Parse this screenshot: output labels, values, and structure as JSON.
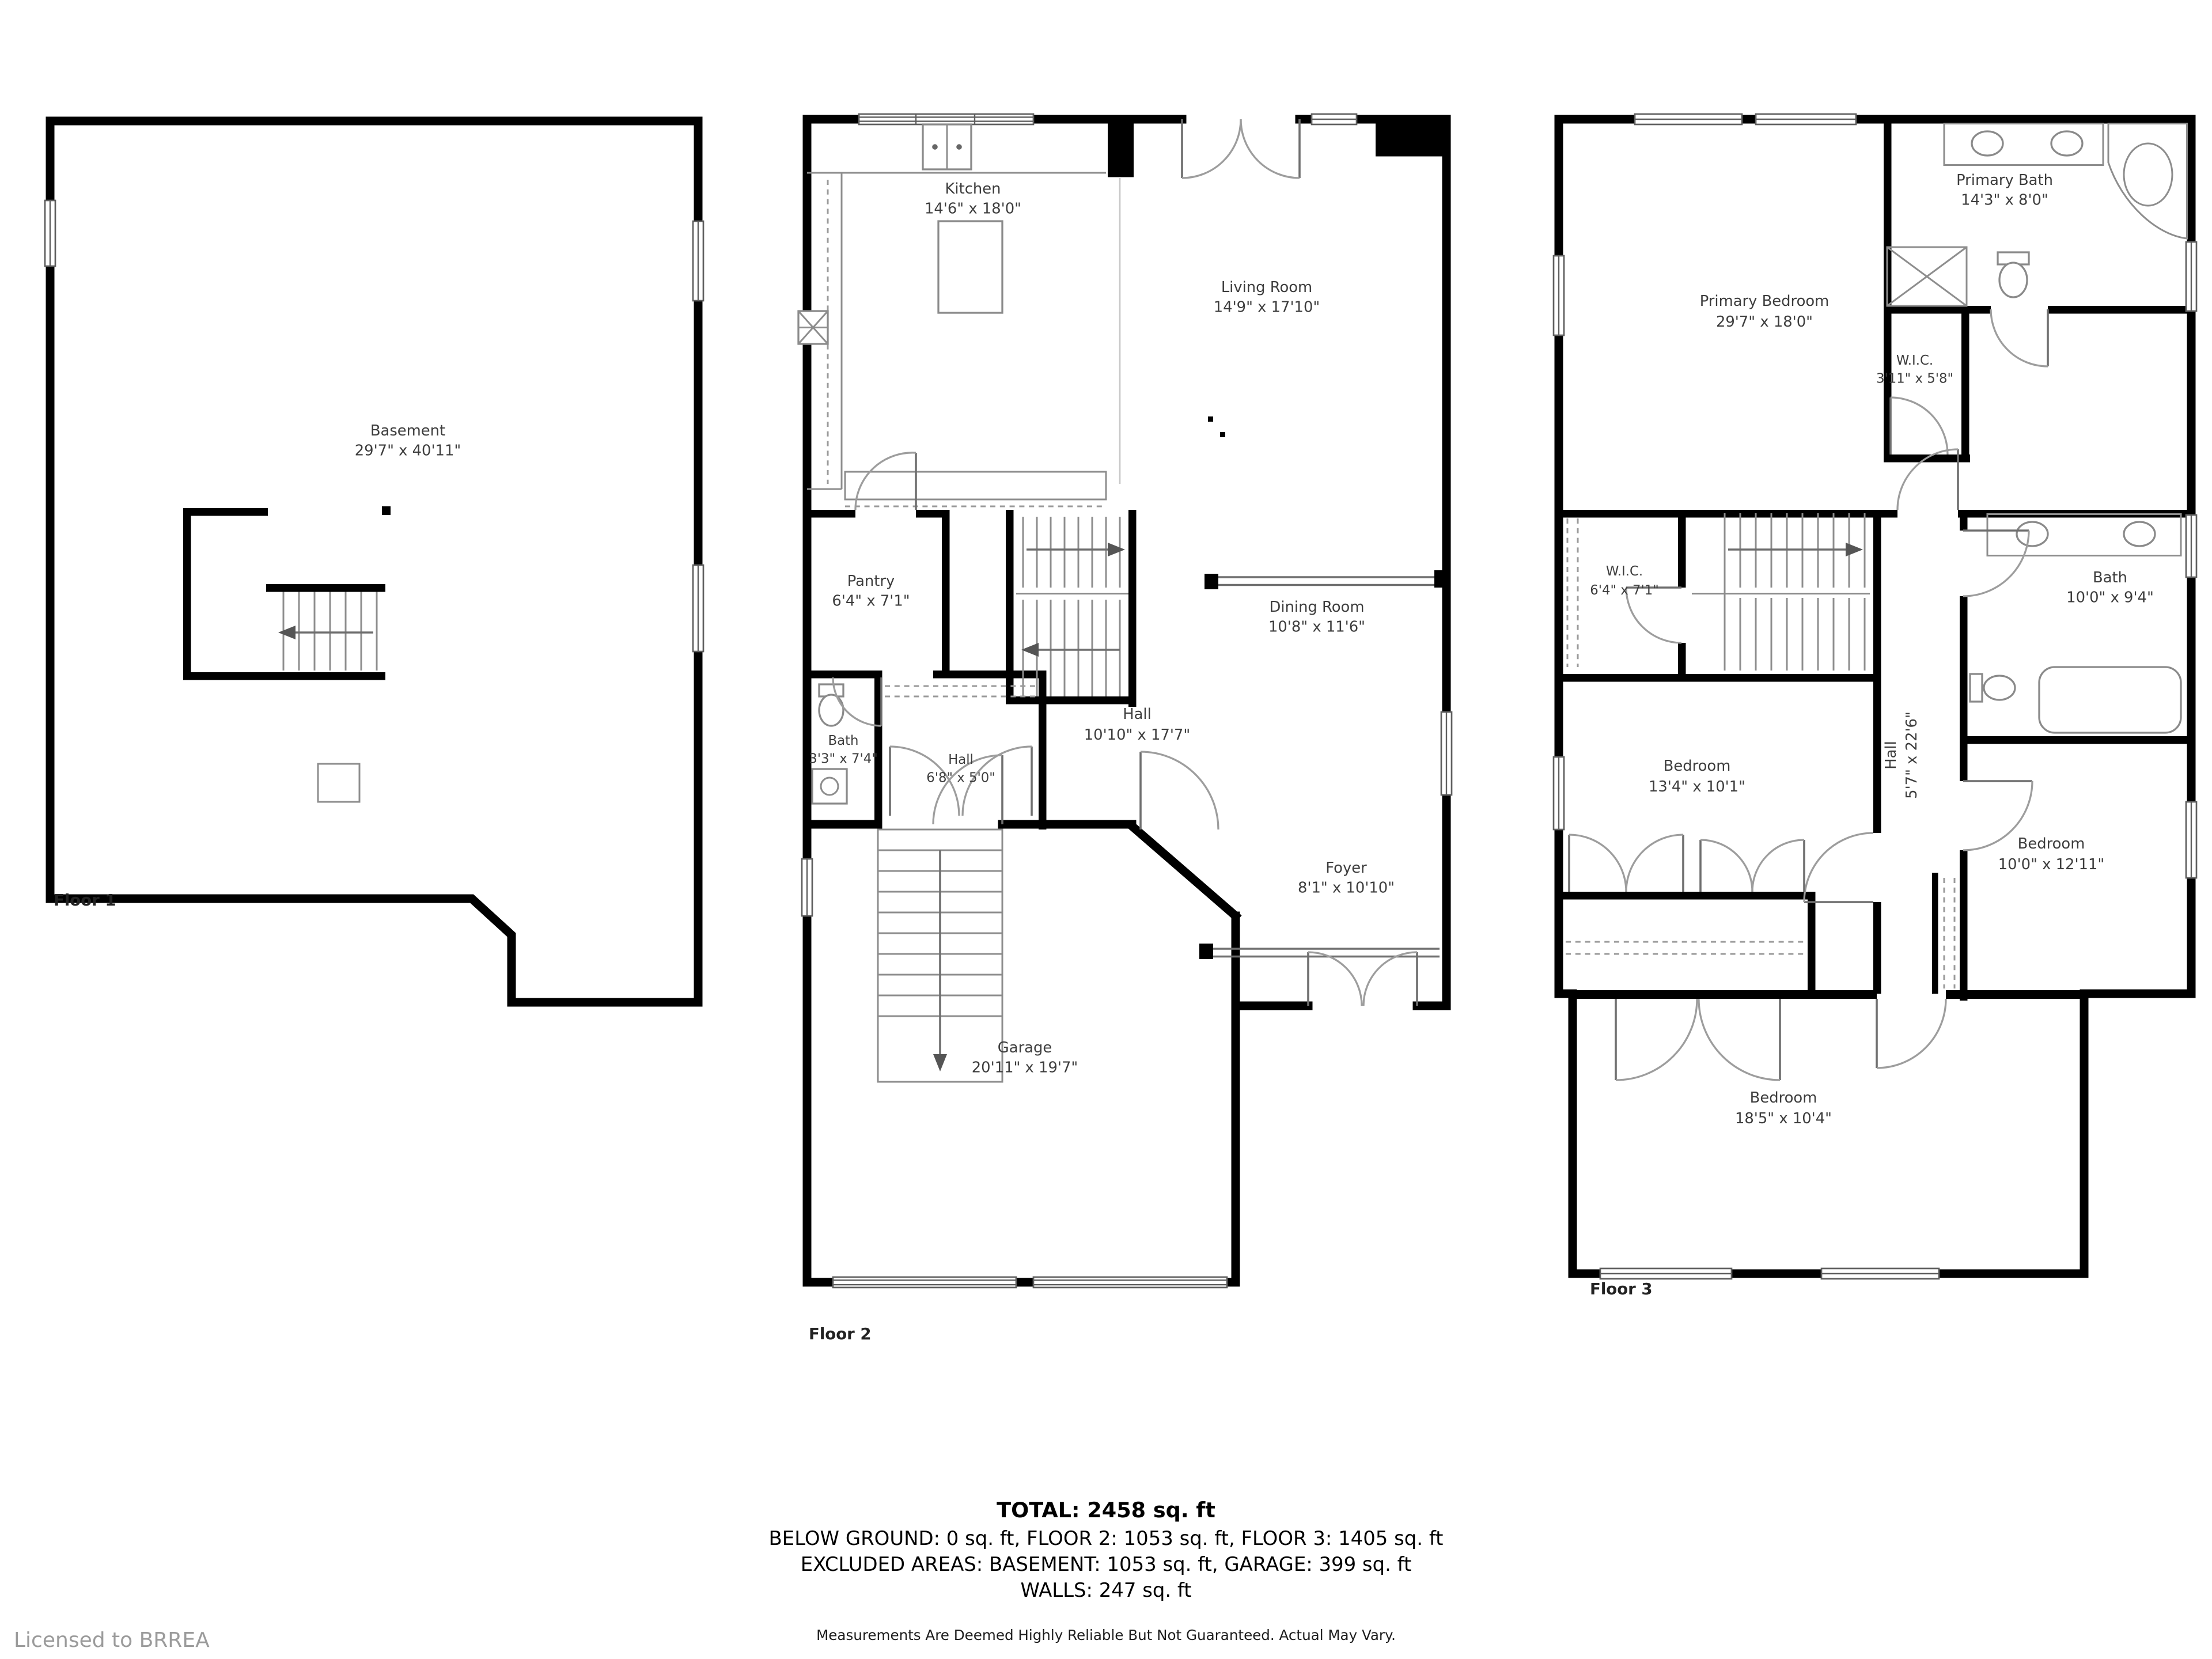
{
  "branding": {
    "licensed_to": "Licensed to BRREA"
  },
  "floors": [
    {
      "label": "Floor 1",
      "rooms": [
        {
          "name": "Basement",
          "dims": "29'7\" x 40'11\""
        }
      ]
    },
    {
      "label": "Floor 2",
      "rooms": [
        {
          "name": "Kitchen",
          "dims": "14'6\" x 18'0\""
        },
        {
          "name": "Living Room",
          "dims": "14'9\" x 17'10\""
        },
        {
          "name": "Pantry",
          "dims": "6'4\" x 7'1\""
        },
        {
          "name": "Dining Room",
          "dims": "10'8\" x 11'6\""
        },
        {
          "name": "Bath",
          "dims": "3'3\" x 7'4\""
        },
        {
          "name": "Hall",
          "dims": "6'8\" x 5'0\""
        },
        {
          "name": "Hall",
          "dims": "10'10\" x 17'7\""
        },
        {
          "name": "Foyer",
          "dims": "8'1\" x 10'10\""
        },
        {
          "name": "Garage",
          "dims": "20'11\" x 19'7\""
        }
      ]
    },
    {
      "label": "Floor 3",
      "rooms": [
        {
          "name": "Primary Bath",
          "dims": "14'3\" x 8'0\""
        },
        {
          "name": "Primary Bedroom",
          "dims": "29'7\" x 18'0\""
        },
        {
          "name": "W.I.C.",
          "dims": "3'11\" x 5'8\""
        },
        {
          "name": "W.I.C.",
          "dims": "6'4\" x 7'1\""
        },
        {
          "name": "Bath",
          "dims": "10'0\" x 9'4\""
        },
        {
          "name": "Hall",
          "dims": "5'7\" x 22'6\""
        },
        {
          "name": "Bedroom",
          "dims": "13'4\" x 10'1\""
        },
        {
          "name": "Bedroom",
          "dims": "10'0\" x 12'11\""
        },
        {
          "name": "Bedroom",
          "dims": "18'5\" x 10'4\""
        }
      ]
    }
  ],
  "summary": {
    "total": "TOTAL: 2458 sq. ft",
    "breakdown": "BELOW GROUND: 0 sq. ft, FLOOR 2: 1053 sq. ft, FLOOR 3: 1405 sq. ft",
    "excluded": "EXCLUDED AREAS: BASEMENT: 1053 sq. ft, GARAGE: 399 sq. ft",
    "walls": "WALLS: 247 sq. ft",
    "disclaimer": "Measurements Are Deemed Highly Reliable But Not Guaranteed. Actual May Vary."
  }
}
